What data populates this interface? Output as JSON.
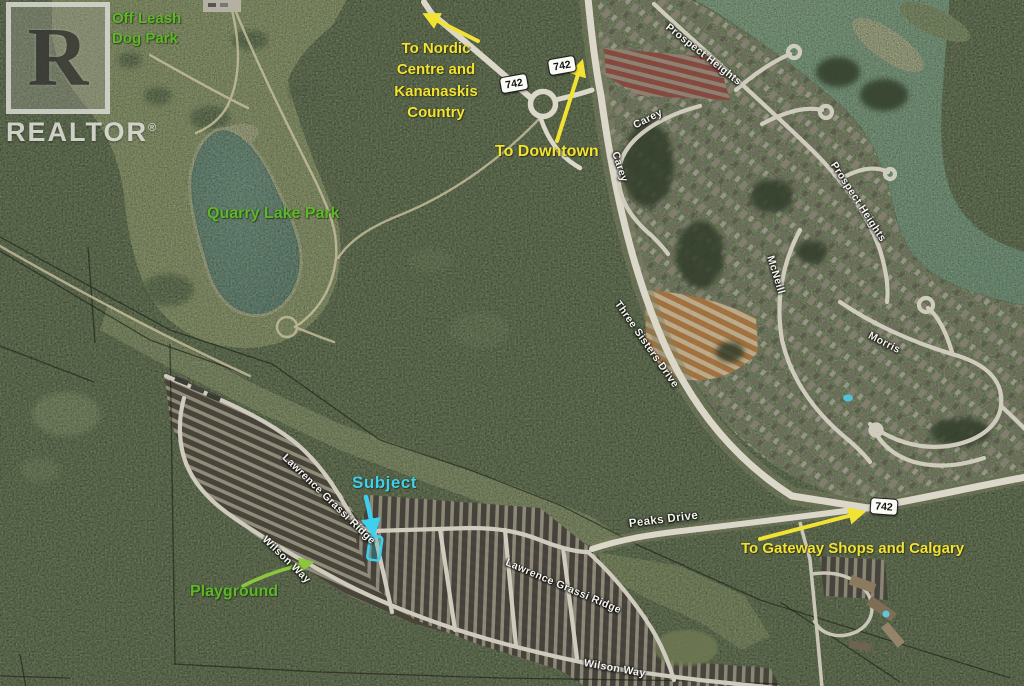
{
  "watermark": {
    "letter": "R",
    "brand": "REALTOR",
    "reg": "®"
  },
  "annotations": {
    "off_leash": "Off Leash\nDog Park",
    "nordic": "To Nordic\nCentre and\nKananaskis\nCountry",
    "downtown": "To Downtown",
    "quarry": "Quarry Lake Park",
    "subject": "Subject",
    "playground": "Playground",
    "gateway": "To Gateway Shops and Calgary"
  },
  "streets": {
    "prospect_heights": "Prospect Heights",
    "carey": "Carey",
    "mcneill": "McNeill",
    "morris": "Morris",
    "three_sisters": "Three Sisters Drive",
    "peaks": "Peaks Drive",
    "lawrence_grassi": "Lawrence Grassi Ridge",
    "wilson_way": "Wilson Way"
  },
  "roads": {
    "shield_label": "742"
  },
  "colors": {
    "annotation_yellow": "#f2e233",
    "annotation_green": "#5cb82a",
    "annotation_cyan": "#3fd0ef",
    "playground_arrow_green": "#8cc63f",
    "street_label_white": "#f5f4ee",
    "water_teal": "#477a7c",
    "river_teal": "#6f9b8d"
  }
}
